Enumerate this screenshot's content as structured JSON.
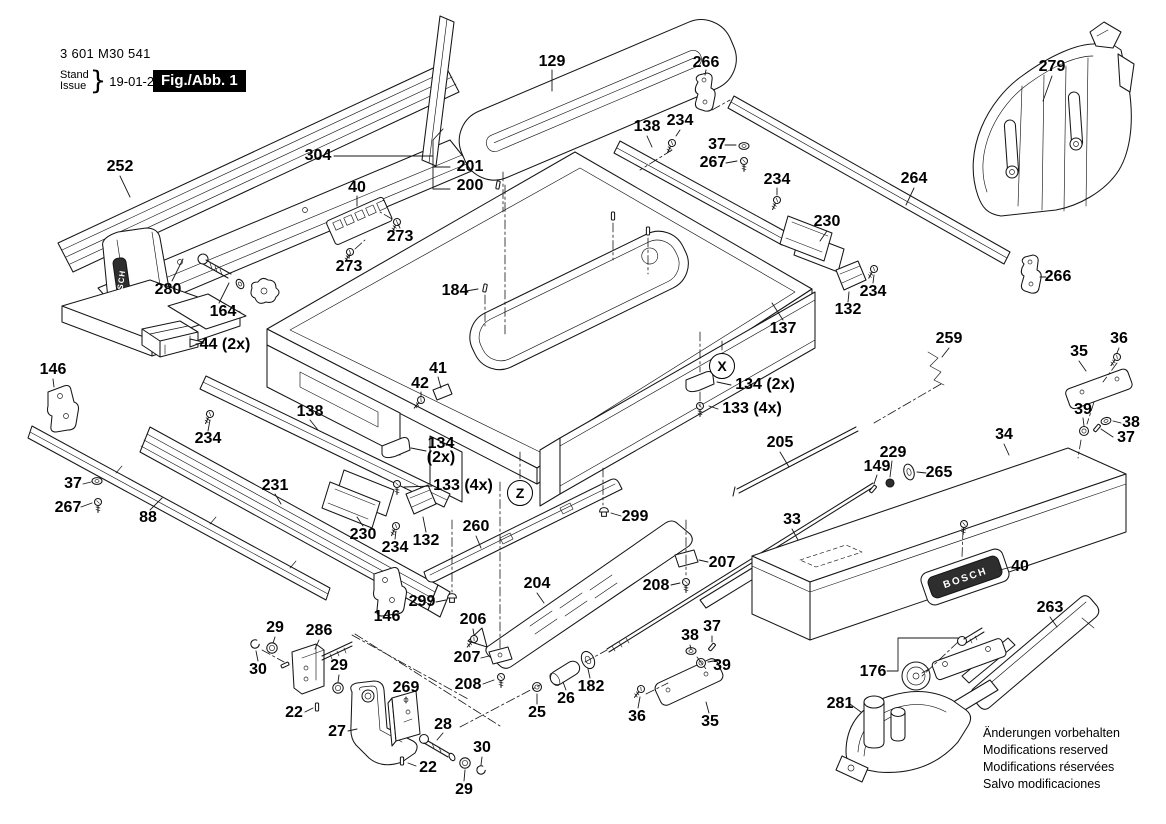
{
  "header": {
    "part_number": "3 601 M30 541",
    "stand_label": "Stand",
    "issue_label": "Issue",
    "brace": "}",
    "date": "19-01-24",
    "figure_label": "Fig./Abb. 1"
  },
  "brand": {
    "name": "BOSCH"
  },
  "colors": {
    "ink": "#161616",
    "paper": "#ffffff",
    "fig_box_bg": "#000000",
    "fig_box_fg": "#ffffff"
  },
  "footer": {
    "lines": [
      "Änderungen vorbehalten",
      "Modifications reserved",
      "Modifications réservées",
      "Salvo modificaciones"
    ]
  },
  "detail_markers": [
    {
      "text": "X",
      "x": 722,
      "y": 366
    },
    {
      "text": "Z",
      "x": 520,
      "y": 493
    }
  ],
  "part_labels": [
    {
      "t": "252",
      "x": 120,
      "y": 167
    },
    {
      "t": "304",
      "x": 318,
      "y": 156
    },
    {
      "t": "201",
      "x": 470,
      "y": 167
    },
    {
      "t": "200",
      "x": 470,
      "y": 186
    },
    {
      "t": "129",
      "x": 552,
      "y": 62
    },
    {
      "t": "266",
      "x": 706,
      "y": 63
    },
    {
      "t": "138",
      "x": 647,
      "y": 127
    },
    {
      "t": "234",
      "x": 680,
      "y": 121
    },
    {
      "t": "37",
      "x": 717,
      "y": 145
    },
    {
      "t": "267",
      "x": 713,
      "y": 163
    },
    {
      "t": "234",
      "x": 777,
      "y": 180
    },
    {
      "t": "264",
      "x": 914,
      "y": 179
    },
    {
      "t": "279",
      "x": 1052,
      "y": 67
    },
    {
      "t": "40",
      "x": 357,
      "y": 188
    },
    {
      "t": "273",
      "x": 400,
      "y": 237
    },
    {
      "t": "273",
      "x": 349,
      "y": 267
    },
    {
      "t": "280",
      "x": 168,
      "y": 290
    },
    {
      "t": "164",
      "x": 223,
      "y": 312
    },
    {
      "t": "44 (2x)",
      "x": 225,
      "y": 345
    },
    {
      "t": "230",
      "x": 827,
      "y": 222
    },
    {
      "t": "234",
      "x": 873,
      "y": 292
    },
    {
      "t": "132",
      "x": 848,
      "y": 310
    },
    {
      "t": "137",
      "x": 783,
      "y": 329
    },
    {
      "t": "266",
      "x": 1058,
      "y": 277
    },
    {
      "t": "146",
      "x": 53,
      "y": 370
    },
    {
      "t": "184",
      "x": 455,
      "y": 291
    },
    {
      "t": "36",
      "x": 1119,
      "y": 339
    },
    {
      "t": "35",
      "x": 1079,
      "y": 352
    },
    {
      "t": "259",
      "x": 949,
      "y": 339
    },
    {
      "t": "134 (2x)",
      "x": 765,
      "y": 385
    },
    {
      "t": "133 (4x)",
      "x": 752,
      "y": 409
    },
    {
      "t": "41",
      "x": 438,
      "y": 369
    },
    {
      "t": "42",
      "x": 420,
      "y": 384
    },
    {
      "t": "39",
      "x": 1083,
      "y": 410
    },
    {
      "t": "38",
      "x": 1131,
      "y": 423
    },
    {
      "t": "37",
      "x": 1126,
      "y": 438
    },
    {
      "t": "34",
      "x": 1004,
      "y": 435
    },
    {
      "t": "138",
      "x": 310,
      "y": 412
    },
    {
      "t": "234",
      "x": 208,
      "y": 439
    },
    {
      "t": "205",
      "x": 780,
      "y": 443
    },
    {
      "t": "229",
      "x": 893,
      "y": 453
    },
    {
      "t": "149",
      "x": 877,
      "y": 467
    },
    {
      "t": "265",
      "x": 939,
      "y": 473
    },
    {
      "t": "231",
      "x": 275,
      "y": 486
    },
    {
      "t": "134",
      "t2": "(2x)",
      "x": 441,
      "y": 451
    },
    {
      "t": "133 (4x)",
      "x": 463,
      "y": 486
    },
    {
      "t": "37",
      "x": 73,
      "y": 484
    },
    {
      "t": "267",
      "x": 68,
      "y": 508
    },
    {
      "t": "88",
      "x": 148,
      "y": 518
    },
    {
      "t": "230",
      "x": 363,
      "y": 535
    },
    {
      "t": "234",
      "x": 395,
      "y": 548
    },
    {
      "t": "132",
      "x": 426,
      "y": 541
    },
    {
      "t": "260",
      "x": 476,
      "y": 527
    },
    {
      "t": "299",
      "x": 635,
      "y": 517
    },
    {
      "t": "33",
      "x": 792,
      "y": 520
    },
    {
      "t": "207",
      "x": 722,
      "y": 563
    },
    {
      "t": "208",
      "x": 656,
      "y": 586
    },
    {
      "t": "204",
      "x": 537,
      "y": 584
    },
    {
      "t": "299",
      "x": 422,
      "y": 602
    },
    {
      "t": "146",
      "x": 387,
      "y": 617
    },
    {
      "t": "206",
      "x": 473,
      "y": 620
    },
    {
      "t": "40",
      "x": 1020,
      "y": 567
    },
    {
      "t": "263",
      "x": 1050,
      "y": 608
    },
    {
      "t": "207",
      "x": 467,
      "y": 658
    },
    {
      "t": "208",
      "x": 468,
      "y": 685
    },
    {
      "t": "38",
      "x": 690,
      "y": 636
    },
    {
      "t": "37",
      "x": 712,
      "y": 627
    },
    {
      "t": "39",
      "x": 722,
      "y": 666
    },
    {
      "t": "29",
      "x": 275,
      "y": 628
    },
    {
      "t": "286",
      "x": 319,
      "y": 631
    },
    {
      "t": "30",
      "x": 258,
      "y": 670
    },
    {
      "t": "29",
      "x": 339,
      "y": 666
    },
    {
      "t": "22",
      "x": 294,
      "y": 713
    },
    {
      "t": "27",
      "x": 337,
      "y": 732
    },
    {
      "t": "269",
      "x": 406,
      "y": 688
    },
    {
      "t": "28",
      "x": 443,
      "y": 725
    },
    {
      "t": "22",
      "x": 428,
      "y": 768
    },
    {
      "t": "30",
      "x": 482,
      "y": 748
    },
    {
      "t": "29",
      "x": 464,
      "y": 790
    },
    {
      "t": "25",
      "x": 537,
      "y": 713
    },
    {
      "t": "26",
      "x": 566,
      "y": 699
    },
    {
      "t": "182",
      "x": 591,
      "y": 687
    },
    {
      "t": "36",
      "x": 637,
      "y": 717
    },
    {
      "t": "35",
      "x": 710,
      "y": 722
    },
    {
      "t": "176",
      "x": 873,
      "y": 672
    },
    {
      "t": "281",
      "x": 840,
      "y": 704
    }
  ]
}
